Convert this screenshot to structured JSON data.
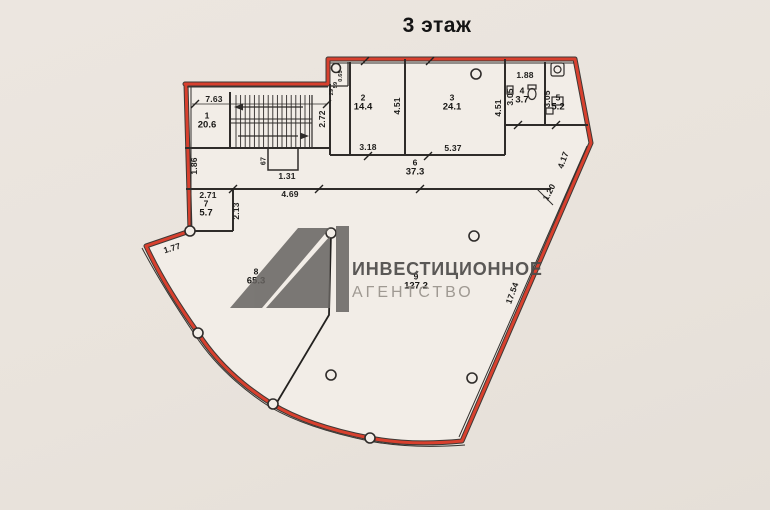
{
  "title": "3 этаж",
  "watermark": {
    "agency_line1": "ИНВЕСТИЦИОННОЕ",
    "agency_line2": "АГЕНТСТВО"
  },
  "colors": {
    "boundary_red": "#d8402e",
    "wall_black": "#2f2c2a",
    "paper": "#f2ede7",
    "background": "#e9e3dc",
    "watermark_dark": "#5f5d5b",
    "watermark_light": "#9b958e"
  },
  "floor_plan": {
    "floor_label": "3 этаж",
    "rooms": [
      {
        "number": "1",
        "area": "20.6",
        "x": 207,
        "y": 121
      },
      {
        "number": "2",
        "area": "14.4",
        "x": 363,
        "y": 103
      },
      {
        "number": "3",
        "area": "24.1",
        "x": 452,
        "y": 103
      },
      {
        "number": "4",
        "area": "3.7",
        "x": 522,
        "y": 96
      },
      {
        "number": "5",
        "area": "5.2",
        "x": 558,
        "y": 103
      },
      {
        "number": "6",
        "area": "37.3",
        "x": 415,
        "y": 168
      },
      {
        "number": "7",
        "area": "5.7",
        "x": 206,
        "y": 209
      },
      {
        "number": "8",
        "area": "65.3",
        "x": 256,
        "y": 277
      },
      {
        "number": "9",
        "area": "127.2",
        "x": 416,
        "y": 282
      }
    ],
    "dimensions": [
      {
        "text": "7.63",
        "x": 214,
        "y": 99,
        "rot": 0
      },
      {
        "text": "1.86",
        "x": 194,
        "y": 166,
        "rot": -90
      },
      {
        "text": "2.72",
        "x": 322,
        "y": 119,
        "rot": -90
      },
      {
        "text": "67",
        "x": 264,
        "y": 161,
        "rot": -90,
        "size": 7
      },
      {
        "text": "1.31",
        "x": 287,
        "y": 176,
        "rot": 0
      },
      {
        "text": "2.71",
        "x": 208,
        "y": 195,
        "rot": 0
      },
      {
        "text": "2.13",
        "x": 236,
        "y": 211,
        "rot": -90
      },
      {
        "text": "4.69",
        "x": 290,
        "y": 194,
        "rot": 0
      },
      {
        "text": "1.77",
        "x": 172,
        "y": 248,
        "rot": -17
      },
      {
        "text": "3.18",
        "x": 368,
        "y": 147,
        "rot": 0
      },
      {
        "text": "5.37",
        "x": 453,
        "y": 148,
        "rot": 0
      },
      {
        "text": "4.51",
        "x": 397,
        "y": 106,
        "rot": -90
      },
      {
        "text": "4.51",
        "x": 498,
        "y": 108,
        "rot": -90
      },
      {
        "text": "1.88",
        "x": 525,
        "y": 75,
        "rot": 0
      },
      {
        "text": "3.05",
        "x": 510,
        "y": 97,
        "rot": -90
      },
      {
        "text": "3.05",
        "x": 547,
        "y": 99,
        "rot": -90
      },
      {
        "text": "4.17",
        "x": 563,
        "y": 160,
        "rot": -70
      },
      {
        "text": "1.20",
        "x": 549,
        "y": 192,
        "rot": -62
      },
      {
        "text": "17.54",
        "x": 512,
        "y": 293,
        "rot": -70
      },
      {
        "text": "0.65",
        "x": 341,
        "y": 76,
        "rot": -90,
        "size": 5.5
      },
      {
        "text": "59",
        "x": 336,
        "y": 85,
        "rot": -90,
        "size": 5.5
      },
      {
        "text": "29",
        "x": 332,
        "y": 92,
        "rot": -90,
        "size": 5.5
      }
    ]
  }
}
